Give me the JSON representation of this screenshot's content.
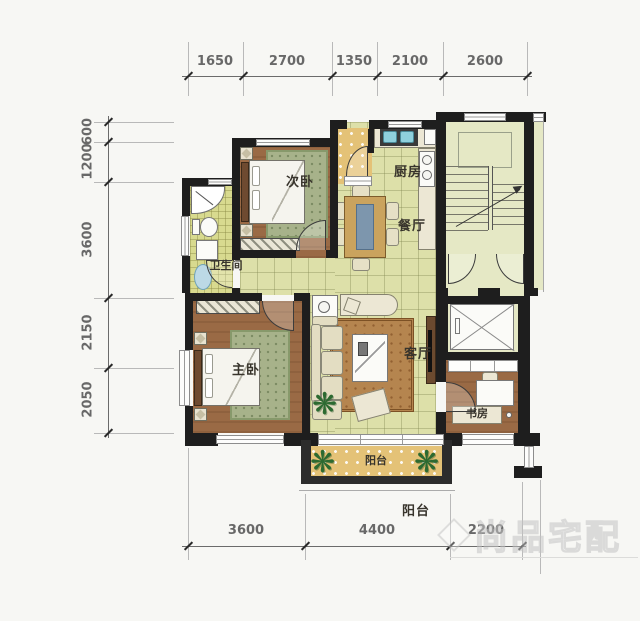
{
  "dimensions": {
    "top": [
      "1650",
      "2700",
      "1350",
      "2100",
      "2600"
    ],
    "left": [
      "600",
      "1200",
      "3600",
      "2150",
      "2050"
    ],
    "bottom": [
      "3600",
      "4400",
      "2200"
    ],
    "balcony_annotation": "阳台"
  },
  "rooms": {
    "secondary_bedroom": "次卧",
    "kitchen": "厨房",
    "dining_room": "餐厅",
    "bathroom": "卫生间",
    "master_bedroom": "主卧",
    "living_room": "客厅",
    "study": "书房",
    "balcony": "阳台"
  },
  "watermark": "尚品宅配",
  "colors": {
    "wall": "#1e1e1e",
    "tile_floor": "#dde0a9",
    "wood_floor": "#9a6a45",
    "rug_green": "#a7b28a",
    "balcony_tile": "#e4c277",
    "stair_floor": "#e5e8c5",
    "sink_blue": "#8fd0dc"
  }
}
